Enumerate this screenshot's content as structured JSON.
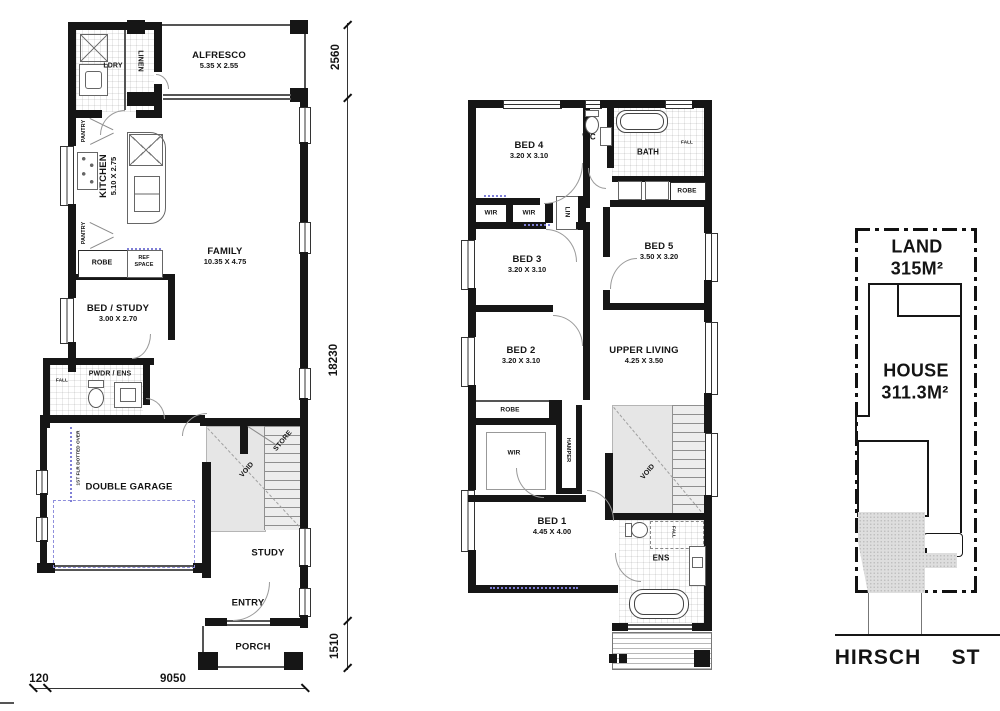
{
  "ground": {
    "rooms": {
      "alfresco": {
        "name": "ALFRESCO",
        "dims": "5.35 X 2.55"
      },
      "kitchen": {
        "name": "KITCHEN",
        "dims": "5.10 X 2.75"
      },
      "family": {
        "name": "FAMILY",
        "dims": "10.35 X 4.75"
      },
      "bed_study": {
        "name": "BED / STUDY",
        "dims": "3.00 X 2.70"
      },
      "garage": {
        "name": "DOUBLE GARAGE"
      },
      "study": {
        "name": "STUDY"
      },
      "entry": {
        "name": "ENTRY"
      },
      "porch": {
        "name": "PORCH"
      }
    },
    "labels": {
      "ldry": "LDRY",
      "linen": "LINEN",
      "pantry_top": "PANTRY",
      "pantry_bottom": "PANTRY",
      "robe": "ROBE",
      "ref_space": "REF SPACE",
      "pwdr_ens": "PWDR / ENS",
      "fall": "FALL",
      "void": "VOID",
      "store": "STORE",
      "first_floor_note": "1ST FLR DOTTED OVER"
    }
  },
  "upper": {
    "rooms": {
      "bed1": {
        "name": "BED 1",
        "dims": "4.45 X 4.00"
      },
      "bed2": {
        "name": "BED 2",
        "dims": "3.20 X 3.10"
      },
      "bed3": {
        "name": "BED 3",
        "dims": "3.20 X 3.10"
      },
      "bed4": {
        "name": "BED 4",
        "dims": "3.20 X 3.10"
      },
      "bed5": {
        "name": "BED 5",
        "dims": "3.50 X 3.20"
      },
      "upper_living": {
        "name": "UPPER LIVING",
        "dims": "4.25 X 3.50"
      }
    },
    "labels": {
      "wc": "WC",
      "bath": "BATH",
      "fall_bath": "FALL",
      "robe_bed5": "ROBE",
      "wir_left": "WIR",
      "wir_mid": "WIR",
      "lin": "LIN",
      "robe_bed2": "ROBE",
      "hamper": "HAMPER",
      "wir_bed1": "WIR",
      "void": "VOID",
      "ens": "ENS",
      "fall_ens": "FALL"
    }
  },
  "site": {
    "land_label": "LAND",
    "land_area": "315M²",
    "house_label": "HOUSE",
    "house_area": "311.3M²",
    "street_name": "HIRSCH",
    "street_suffix": "ST"
  },
  "dims": {
    "alfresco_depth": "2560",
    "house_length": "18230",
    "porch_depth": "1510",
    "left_offset": "120",
    "frontage": "9050"
  }
}
